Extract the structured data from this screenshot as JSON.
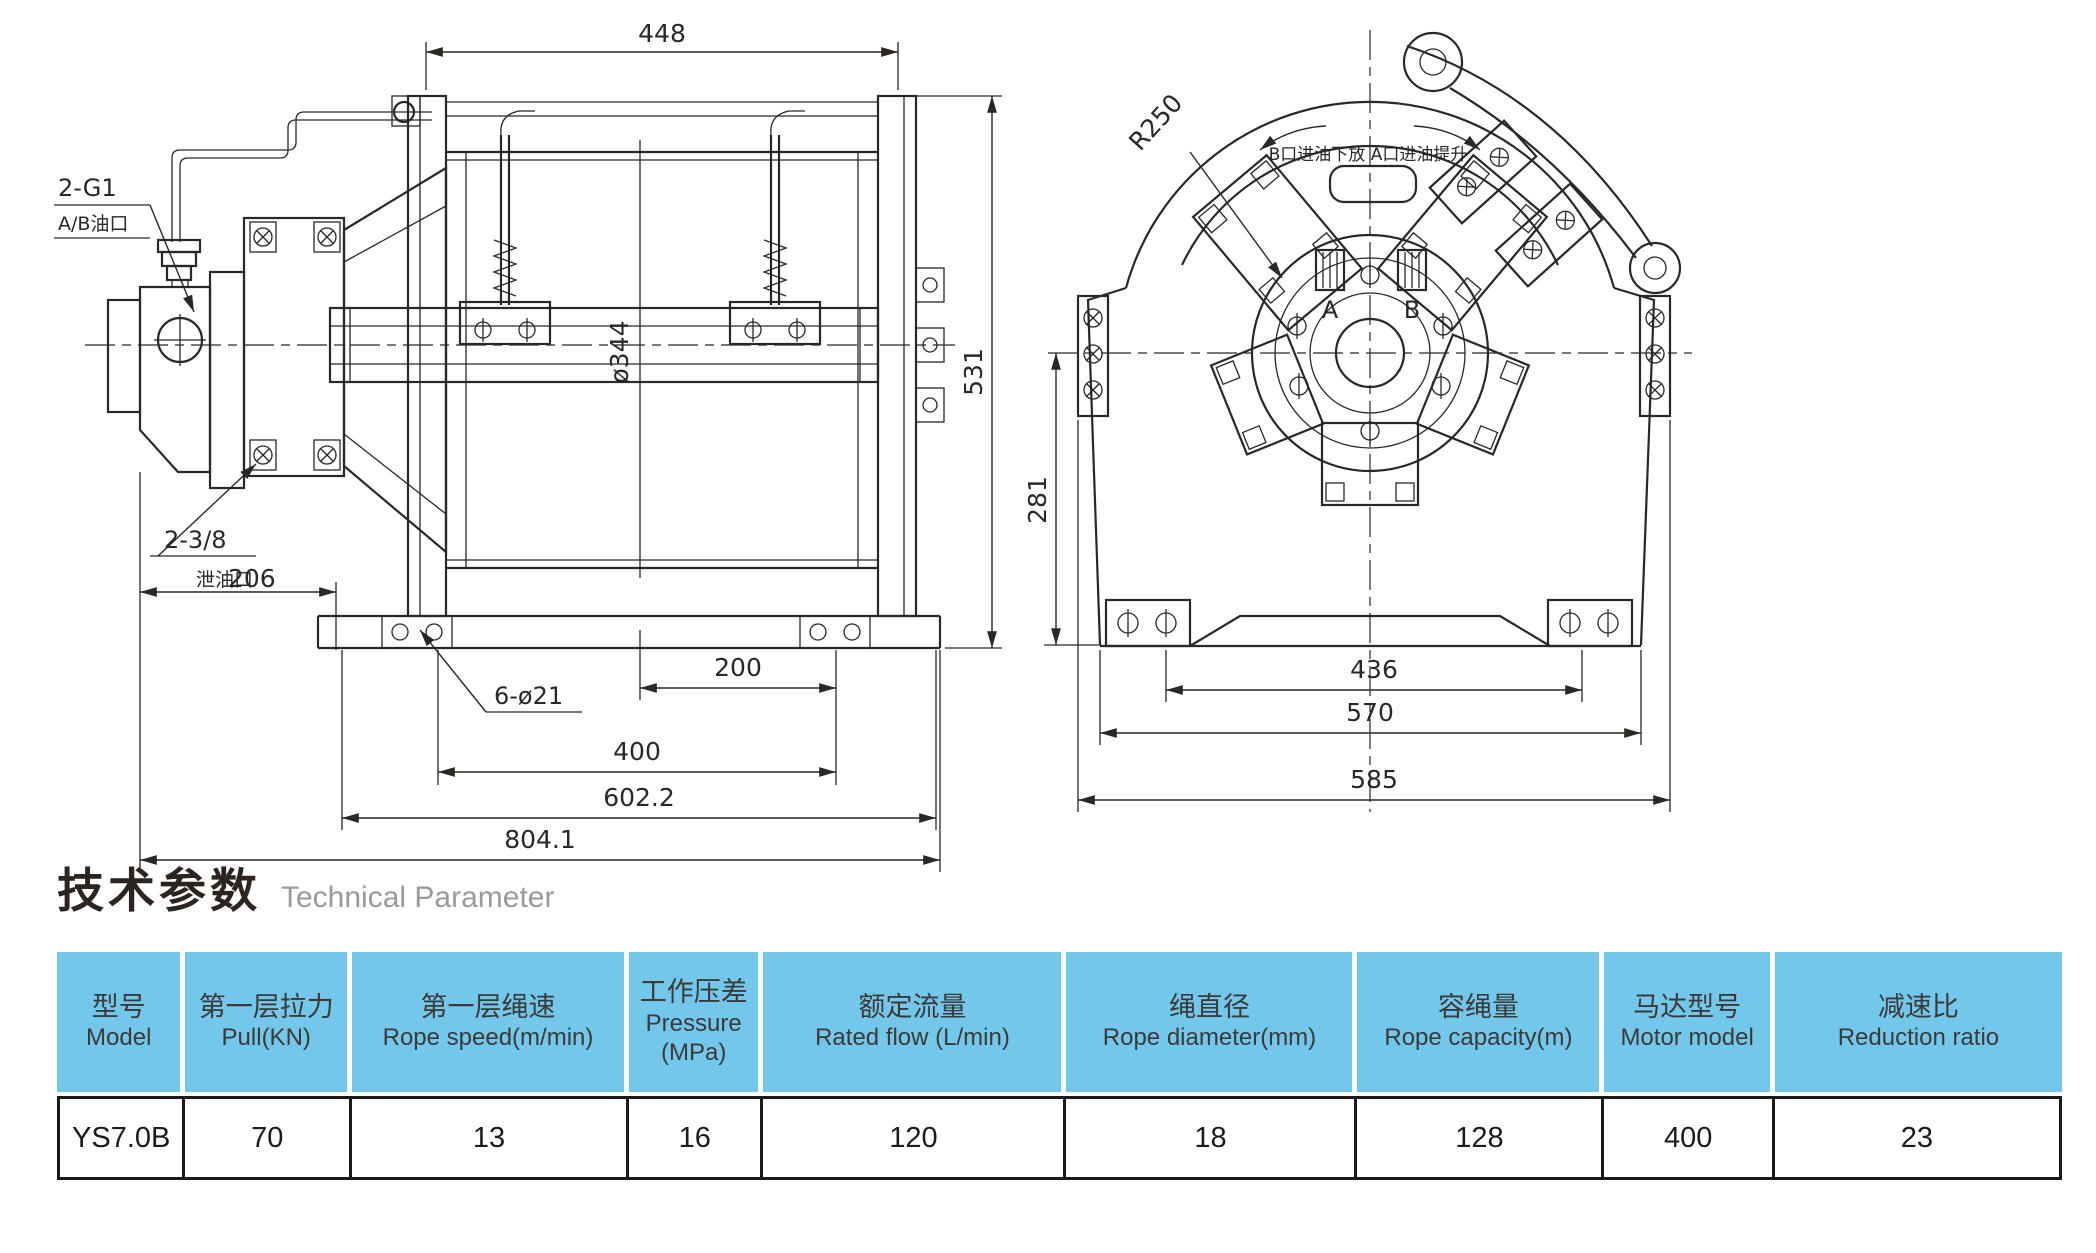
{
  "title": {
    "zh": "技术参数",
    "en": "Technical Parameter"
  },
  "left_view": {
    "labels": {
      "port1": "2-G1",
      "port2": "A/B油口",
      "drain1": "2-3/8",
      "drain2": "泄油口",
      "holes": "6-ø21"
    },
    "dims": {
      "width_top": "448",
      "height": "531",
      "drum_dia": "ø344",
      "drain_offset": "206",
      "bolt_half": "200",
      "bolt_span": "400",
      "base_width": "602.2",
      "total": "804.1"
    }
  },
  "right_view": {
    "labels": {
      "radius": "R250",
      "note": "B口进油下放  A口进油提升",
      "port_a": "A",
      "port_b": "B"
    },
    "dims": {
      "center_height": "281",
      "foot_span": "436",
      "base_width": "570",
      "overall": "585"
    }
  },
  "table": {
    "columns": [
      {
        "zh": "型号",
        "en": "Model"
      },
      {
        "zh": "第一层拉力",
        "en": "Pull(KN)"
      },
      {
        "zh": "第一层绳速",
        "en": "Rope speed(m/min)"
      },
      {
        "zh": "工作压差",
        "en": "Pressure",
        "en2": "(MPa)"
      },
      {
        "zh": "额定流量",
        "en": "Rated flow (L/min)"
      },
      {
        "zh": "绳直径",
        "en": "Rope diameter(mm)"
      },
      {
        "zh": "容绳量",
        "en": "Rope capacity(m)"
      },
      {
        "zh": "马达型号",
        "en": "Motor model"
      },
      {
        "zh": "减速比",
        "en": "Reduction ratio"
      }
    ],
    "rows": [
      [
        "YS7.0B",
        "70",
        "13",
        "16",
        "120",
        "18",
        "128",
        "400",
        "23"
      ]
    ]
  },
  "colors": {
    "header_bg": "#72c7eb",
    "line": "#2b2724"
  }
}
